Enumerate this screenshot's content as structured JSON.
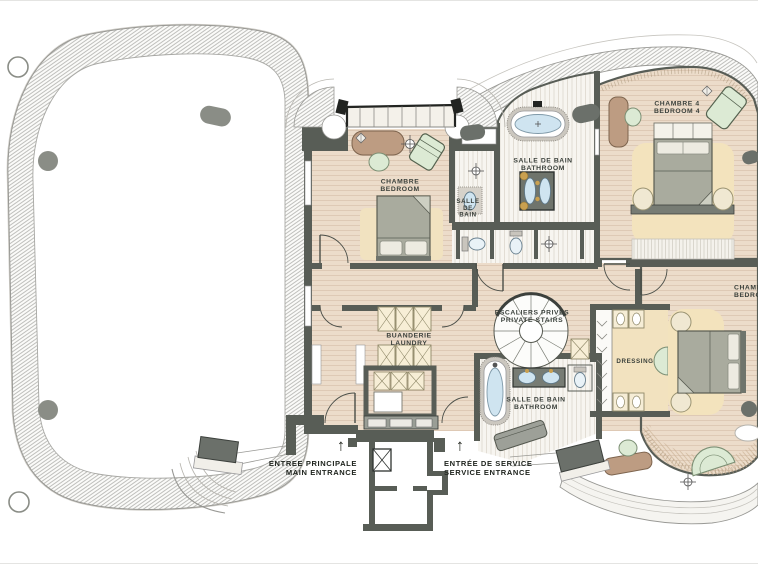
{
  "drawing": {
    "type": "architectural-floor-plan",
    "colors": {
      "wall": "#585d56",
      "wood_floor": "#ecdcca",
      "tile_floor": "#f7f5f0",
      "bed_surround_yellow": "#f3e3bd",
      "water_blue": "#cfe4f0",
      "furniture_green": "#dcead4",
      "furniture_brown": "#bd9c82",
      "label_text": "#3a403b"
    }
  },
  "rooms": {
    "bedroom1": {
      "fr": "CHAMBRE",
      "en": "BEDROOM"
    },
    "bath_small": {
      "l1": "SALLE",
      "l2": "DE",
      "l3": "BAIN"
    },
    "bathroom_main": {
      "fr": "SALLE DE BAIN",
      "en": "BATHROOM"
    },
    "bedroom4": {
      "fr": "CHAMBRE 4",
      "en": "BEDROOM 4"
    },
    "stairs": {
      "fr": "ESCALIERS PRIVÉS",
      "en": "PRIVATE STAIRS"
    },
    "laundry": {
      "fr": "BUANDERIE",
      "en": "LAUNDRY"
    },
    "bathroom_lower": {
      "fr": "SALLE DE BAIN",
      "en": "BATHROOM"
    },
    "dressing": {
      "fr": "DRESSING"
    },
    "bedroom_right": {
      "fr": "CHAMBRE",
      "en": "BEDROOM"
    }
  },
  "entrances": {
    "main": {
      "fr": "ENTREE PRINCIPALE",
      "en": "MAIN ENTRANCE",
      "arrow": "↑"
    },
    "service": {
      "fr": "ENTRÉE DE SERVICE",
      "en": "SERVICE ENTRANCE",
      "arrow": "↑"
    }
  }
}
